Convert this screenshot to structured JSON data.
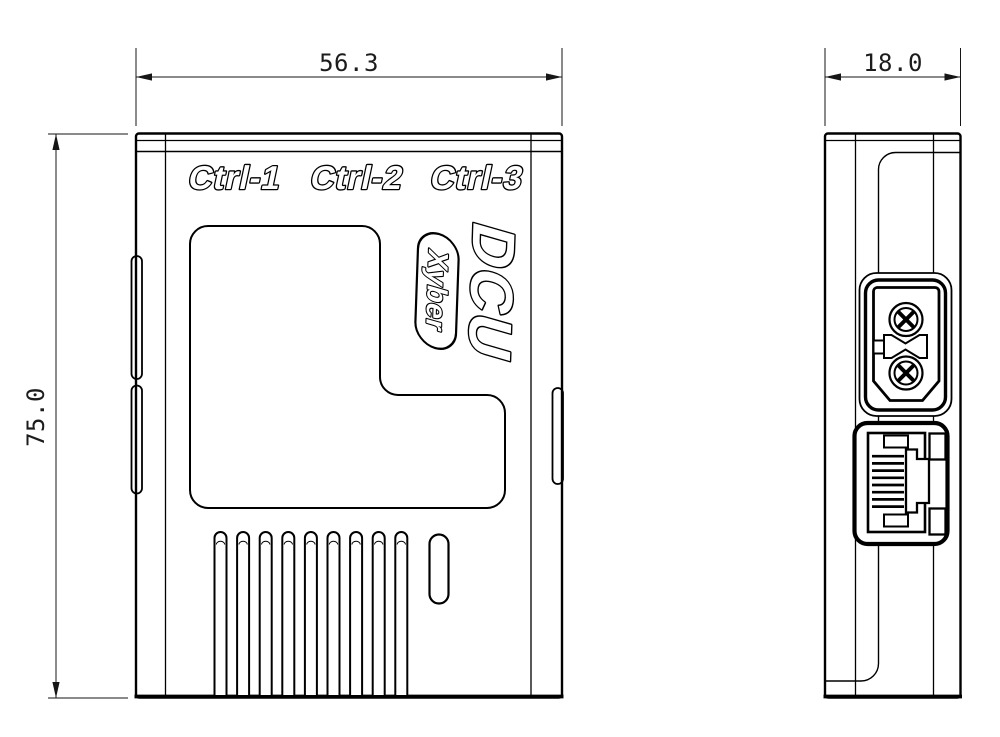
{
  "drawing": {
    "front_view": {
      "width_dim": "56.3",
      "height_dim": "75.0",
      "port_labels": [
        "Ctrl-1",
        "Ctrl-2",
        "Ctrl-3"
      ],
      "model_label": "DCU",
      "brand_label": "Xyber",
      "vent_slot_count": 9
    },
    "side_view": {
      "width_dim": "18.0"
    },
    "colors": {
      "line": "#000000",
      "background": "#ffffff",
      "dim_text": "#1c1c1c"
    }
  }
}
